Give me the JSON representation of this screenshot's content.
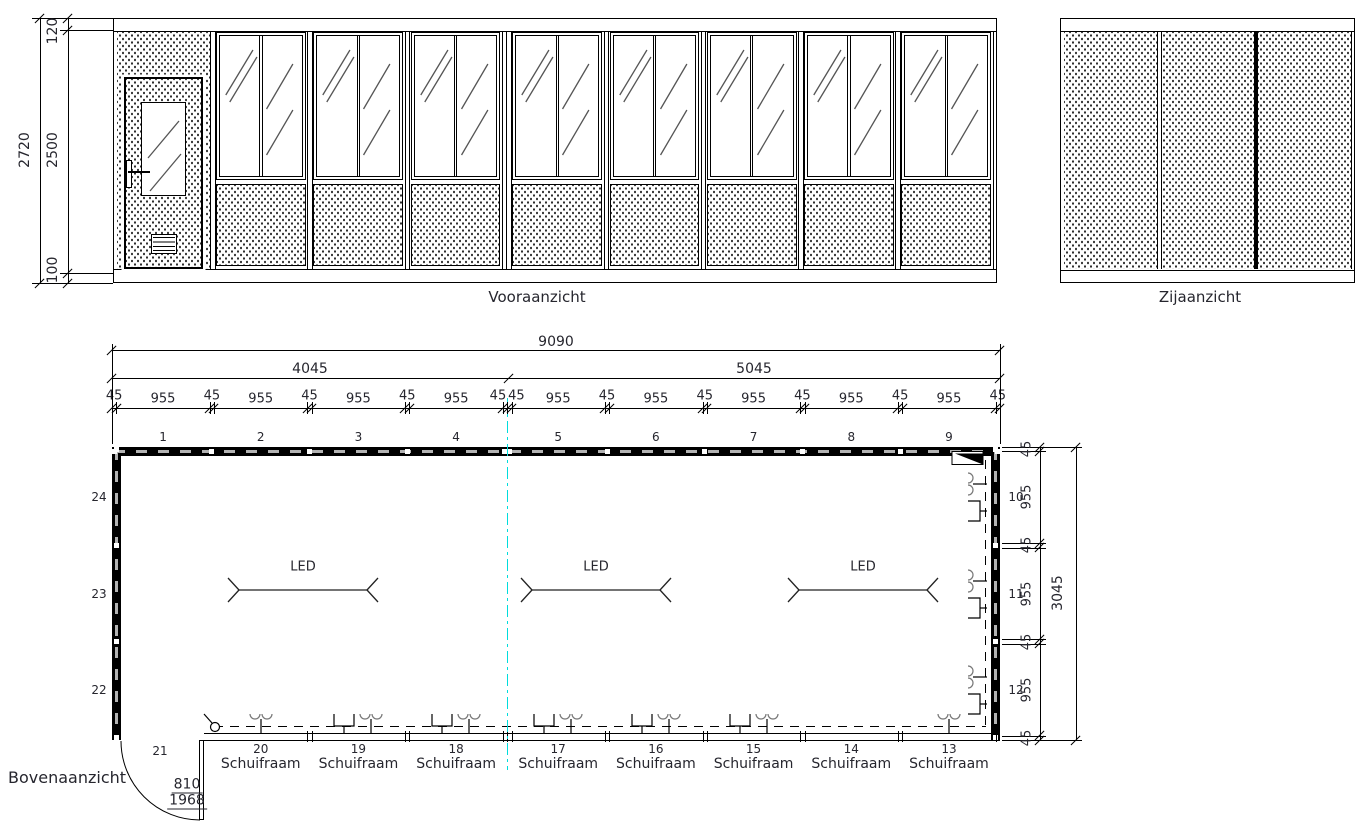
{
  "drawing": {
    "views": {
      "front_label": "Vooraanzicht",
      "side_label": "Zijaanzicht",
      "plan_label": "Bovenaanzicht"
    },
    "front_dims": {
      "total": "2720",
      "top": "120",
      "middle": "2500",
      "bottom": "100"
    },
    "plan_dims": {
      "total": "9090",
      "left_span": "4045",
      "right_span": "5045",
      "top_chain": [
        "45",
        "955",
        "45",
        "955",
        "45",
        "955",
        "45",
        "955",
        "45",
        "45",
        "955",
        "45",
        "955",
        "45",
        "955",
        "45",
        "955",
        "45",
        "955",
        "45"
      ],
      "right_chain": [
        "45",
        "955",
        "45",
        "955",
        "45",
        "955",
        "45"
      ],
      "right_total": "3045",
      "door": {
        "width": "810",
        "height": "1968"
      }
    },
    "position_numbers": {
      "top": [
        "1",
        "2",
        "3",
        "4",
        "5",
        "6",
        "7",
        "8",
        "9"
      ],
      "right": [
        "10",
        "11",
        "12"
      ],
      "bottom": [
        "20",
        "19",
        "18",
        "17",
        "16",
        "15",
        "14",
        "13"
      ],
      "door": "21",
      "left": [
        "24",
        "23",
        "22"
      ]
    },
    "labels": {
      "led": "LED",
      "schuifraam": "Schuifraam"
    },
    "colors": {
      "line": "#000000",
      "text": "#26262e",
      "centerline": "#00dcdc",
      "wall_dash": "#b3b3b3",
      "glass_line": "#555555"
    }
  }
}
